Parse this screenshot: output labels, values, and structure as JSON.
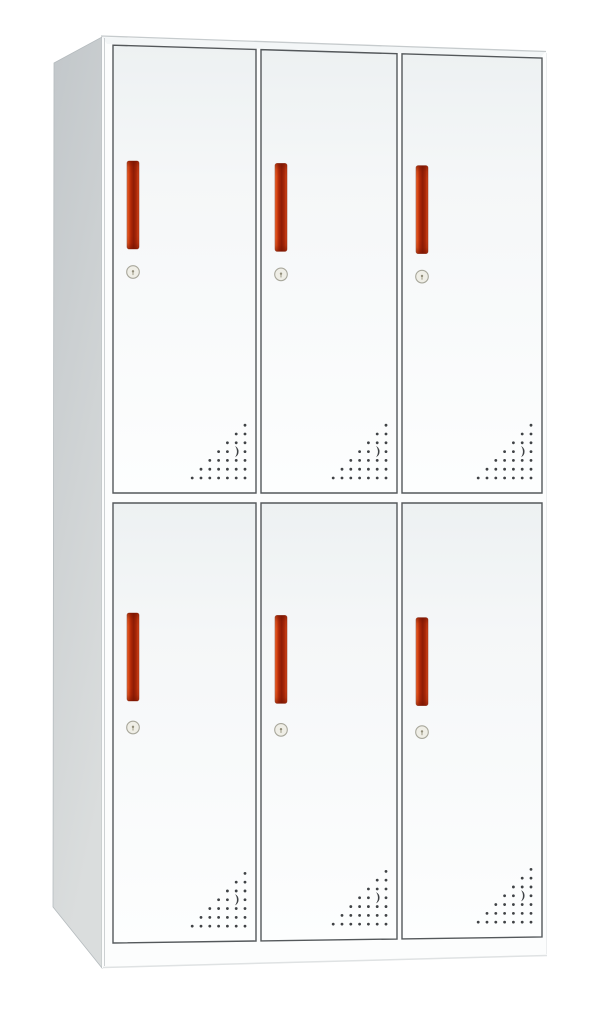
{
  "scene": {
    "type": "product-photo",
    "subject": "White steel locker cabinet with six doors (2 rows x 3 columns), each door with a vertical red handle, a round cam lock below the handle, and a triangular pattern of ventilation perforations with a crescent cutout in the lower-right corner; cabinet shown in slight left perspective on a plain white background",
    "background_color": "#ffffff",
    "door_count": 6,
    "rows": 2,
    "columns": 3
  },
  "palette": {
    "background": "#ffffff",
    "front_fill": "#fcfdfd",
    "top_sliver": "#f3f6f7",
    "top_edge_line": "#c6cbcd",
    "side_front_line": "#b9bec1",
    "bottom_edge_line": "#dfe2e3",
    "right_edge_line": "#eceeef",
    "side_outline": "#b5bbbe",
    "door_outline": "#54585b",
    "handle_stroke": "rgba(125,25,3,0.55)",
    "lock_face": "#efeee6",
    "lock_ring": "#a8a79b",
    "lock_dot": "#928e7a",
    "lock_slot": "#b5b2a0",
    "vent_dot": "#3f4245",
    "gradients": {
      "side": {
        "x1": 0,
        "y1": 0,
        "x2": 0.25,
        "y2": 1,
        "stops": [
          [
            0,
            "#c2c7ca"
          ],
          [
            1,
            "#dadddd"
          ]
        ]
      },
      "door": {
        "x1": 0,
        "y1": 0,
        "x2": 0,
        "y2": 1,
        "stops": [
          [
            0,
            "#edf1f2"
          ],
          [
            0.3,
            "#f5f7f8"
          ],
          [
            1,
            "#fdfefe"
          ]
        ]
      },
      "handle": {
        "x1": 0,
        "y1": 0,
        "x2": 1,
        "y2": 0,
        "stops": [
          [
            0,
            "#f08a5c"
          ],
          [
            0.1,
            "#e25019"
          ],
          [
            0.32,
            "#b02808"
          ],
          [
            0.55,
            "#8e1c05"
          ],
          [
            0.78,
            "#aa2808"
          ],
          [
            1,
            "#d64a1e"
          ]
        ]
      },
      "handleTip": {
        "x1": 0,
        "y1": 0,
        "x2": 0,
        "y2": 1,
        "stops": [
          [
            0,
            "rgba(105,16,0,0.50)"
          ],
          [
            0.07,
            "rgba(105,16,0,0.12)"
          ],
          [
            0.15,
            "rgba(105,16,0,0)"
          ],
          [
            0.85,
            "rgba(105,16,0,0)"
          ],
          [
            0.93,
            "rgba(105,16,0,0.12)"
          ],
          [
            1,
            "rgba(105,16,0,0.50)"
          ]
        ]
      }
    }
  },
  "cabinet": {
    "canvas": {
      "width": 605,
      "height": 1009
    },
    "side_panel_points": [
      [
        54,
        63
      ],
      [
        102,
        37
      ],
      [
        102,
        968
      ],
      [
        53,
        907
      ]
    ],
    "front_points": [
      [
        102,
        37
      ],
      [
        547,
        52
      ],
      [
        547,
        955
      ],
      [
        102,
        968
      ]
    ],
    "top_sliver_points": [
      [
        102,
        37
      ],
      [
        545,
        52
      ],
      [
        541,
        57
      ],
      [
        107,
        44
      ]
    ],
    "top_edge_line": {
      "x1": 101,
      "y1": 36,
      "x2": 546,
      "y2": 51.5
    },
    "side_front_line": {
      "x1": 104.5,
      "y1": 38,
      "x2": 104.5,
      "y2": 966
    },
    "right_edge_line": {
      "x1": 546.5,
      "y1": 53,
      "x2": 546.5,
      "y2": 954
    },
    "bottom_edge_line": {
      "x1": 103,
      "y1": 967.5,
      "x2": 547,
      "y2": 955.5
    },
    "door_columns": [
      [
        113,
        256
      ],
      [
        261,
        397
      ],
      [
        402,
        542
      ]
    ],
    "row_top": {
      "anchor_x": 107,
      "anchor_y": 45,
      "slope": 0.03,
      "bottom_y": 493
    },
    "row_bottom": {
      "top_y": 503,
      "anchor_x": 113,
      "anchor_y": 943,
      "slope": -0.014
    },
    "handle": {
      "width": 12,
      "height": 88,
      "corner_radius": 2.2,
      "offset_from_door_left": 14,
      "row1_top_y": 161,
      "row2_top_y": 613,
      "y_slope": 0.016,
      "slope_anchor_x": 134
    },
    "lock": {
      "radius": 6.3,
      "dot_radius": 1.2,
      "row1_cy": 272,
      "row2_cy": 727.5,
      "y_slope": 0.016,
      "slope_anchor_x": 134
    },
    "vents": {
      "rows": 7,
      "spacing": 8.8,
      "dot_radius": 1.4,
      "right_margin": 11,
      "bottom_margin": 15,
      "crescent_row_from_bottom": 3,
      "crescent_col_from_right": 1,
      "crescent_half_height": 5.6
    }
  },
  "doors": [
    {
      "id": "top-left",
      "row": 0,
      "col": 0,
      "has_handle": true,
      "has_lock": true,
      "has_vents": true
    },
    {
      "id": "top-center",
      "row": 0,
      "col": 1,
      "has_handle": true,
      "has_lock": true,
      "has_vents": true
    },
    {
      "id": "top-right",
      "row": 0,
      "col": 2,
      "has_handle": true,
      "has_lock": true,
      "has_vents": true
    },
    {
      "id": "bottom-left",
      "row": 1,
      "col": 0,
      "has_handle": true,
      "has_lock": true,
      "has_vents": true
    },
    {
      "id": "bottom-center",
      "row": 1,
      "col": 1,
      "has_handle": true,
      "has_lock": true,
      "has_vents": true
    },
    {
      "id": "bottom-right",
      "row": 1,
      "col": 2,
      "has_handle": true,
      "has_lock": true,
      "has_vents": true
    }
  ]
}
